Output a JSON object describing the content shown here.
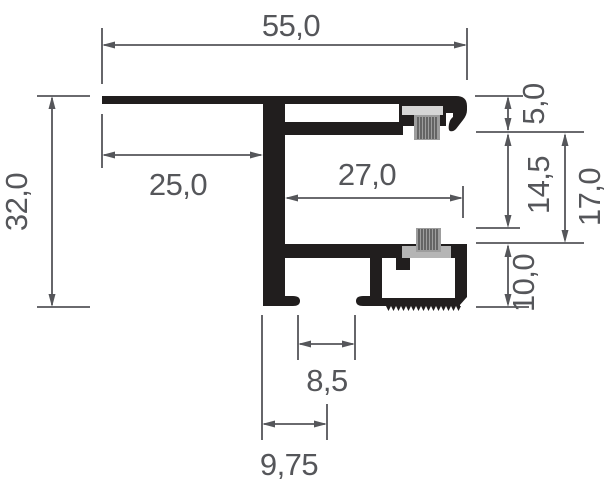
{
  "drawing": {
    "kind": "aluminium-profile-cross-section",
    "units_implied": "mm"
  },
  "labels": {
    "overall_width": "55,0",
    "overall_height": "32,0",
    "flange_offset": "25,0",
    "chamber_width": "27,0",
    "cap_height": "5,0",
    "brush_gap": "14,5",
    "chamber_gap": "17,0",
    "base_height": "10,0",
    "slot_width": "8,5",
    "slot_offset": "9,75"
  },
  "colors": {
    "profile": "#211e1e",
    "dimension": "#55565a",
    "brush_bristles": "#9d9d9d",
    "brush_stripe": "#474747",
    "brush_channel": "#d6d6d6",
    "brush_holder": "#b5b5b5",
    "background": "#ffffff"
  }
}
